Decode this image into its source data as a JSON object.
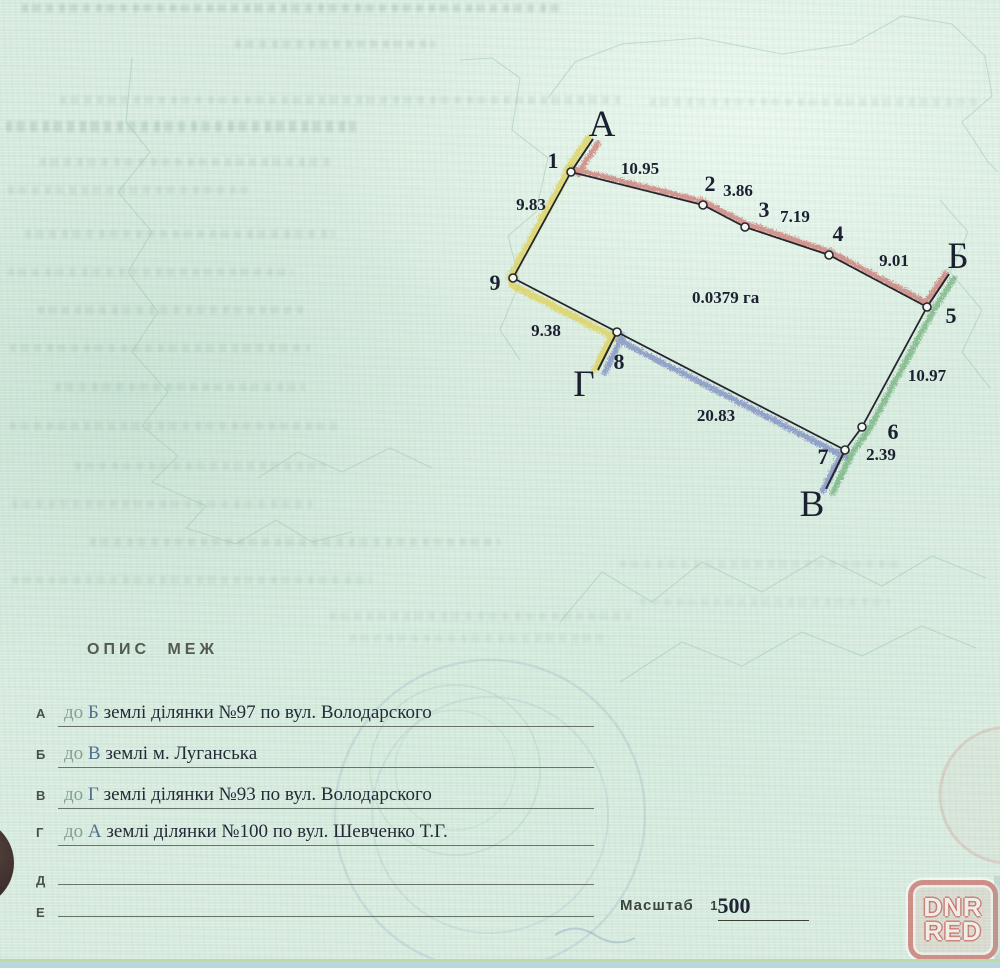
{
  "plan": {
    "corner_labels": {
      "a": "А",
      "b": "Б",
      "v": "В",
      "g": "Г"
    },
    "vertices": [
      "1",
      "2",
      "3",
      "4",
      "5",
      "6",
      "7",
      "8",
      "9"
    ],
    "measurements": {
      "s12": "10.95",
      "s23": "3.86",
      "s34": "7.19",
      "s45": "9.01",
      "s56": "10.97",
      "s67": "2.39",
      "s78": "20.83",
      "s89": "9.38",
      "s91": "9.83"
    },
    "area": "0.0379 га",
    "boundary_colors": {
      "north": "#c24b49",
      "east": "#4d9a58",
      "south": "#4a5ab2",
      "west": "#ddcf4e"
    }
  },
  "description": {
    "title": "ОПИС МЕЖ",
    "rows": [
      {
        "label": "А",
        "pre": "до",
        "target": "Б",
        "text": "землі ділянки №97 по вул. Володарского"
      },
      {
        "label": "Б",
        "pre": "до",
        "target": "В",
        "text": "землі м. Луганська"
      },
      {
        "label": "В",
        "pre": "до",
        "target": "Г",
        "text": "землі ділянки №93 по вул. Володарского"
      },
      {
        "label": "Г",
        "pre": "до",
        "target": "А",
        "text": "землі ділянки №100 по вул. Шевченко Т.Г."
      },
      {
        "label": "Д",
        "pre": "",
        "target": "",
        "text": ""
      },
      {
        "label": "Е",
        "pre": "",
        "target": "",
        "text": ""
      }
    ]
  },
  "scale": {
    "label": "Масштаб",
    "prefix": "1",
    "value": "500"
  },
  "watermark": {
    "line1": "DNR",
    "line2": "RED"
  }
}
